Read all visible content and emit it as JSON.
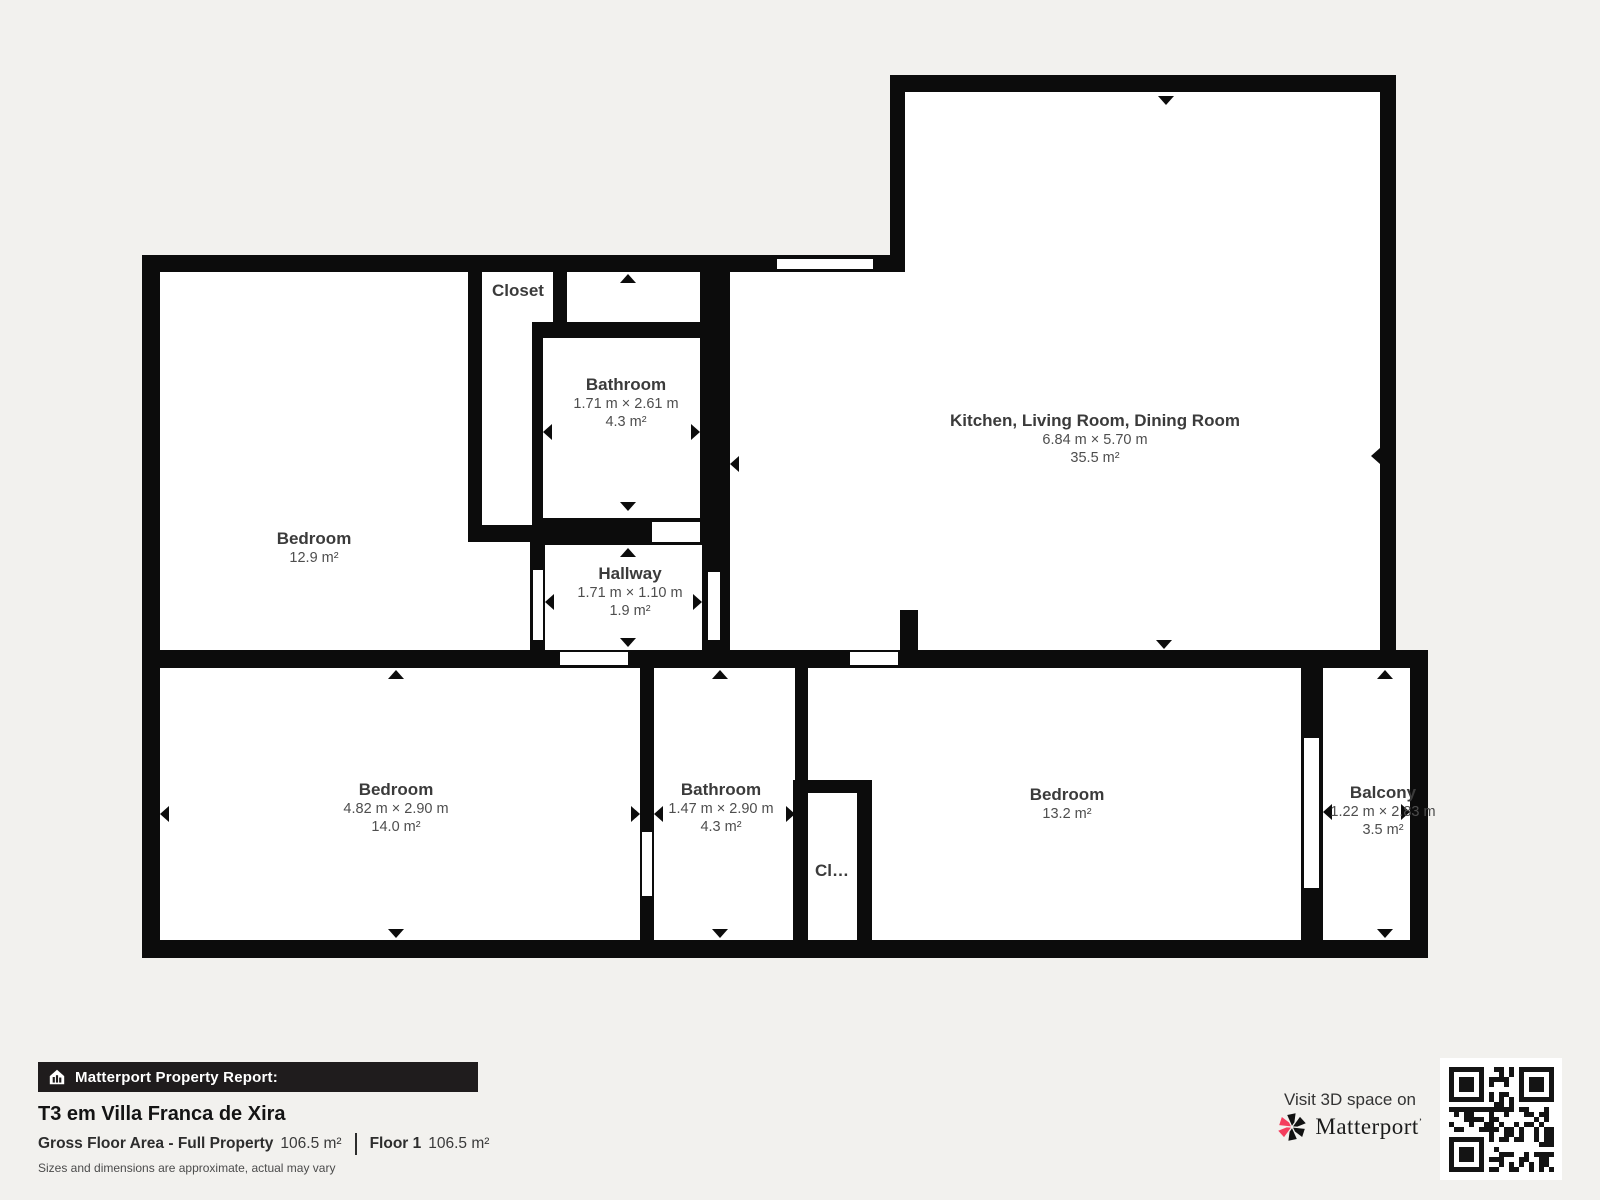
{
  "rooms": {
    "bedroom_tl": {
      "name": "Bedroom",
      "area": "12.9 m²"
    },
    "closet": {
      "name": "Closet"
    },
    "bathroom_tl": {
      "name": "Bathroom",
      "dims": "1.71 m × 2.61 m",
      "area": "4.3 m²"
    },
    "hallway": {
      "name": "Hallway",
      "dims": "1.71 m × 1.10 m",
      "area": "1.9 m²"
    },
    "kitchen": {
      "name": "Kitchen, Living Room, Dining Room",
      "dims": "6.84 m × 5.70 m",
      "area": "35.5 m²"
    },
    "bedroom_bl": {
      "name": "Bedroom",
      "dims": "4.82 m × 2.90 m",
      "area": "14.0 m²"
    },
    "bathroom_bl": {
      "name": "Bathroom",
      "dims": "1.47 m × 2.90 m",
      "area": "4.3 m²"
    },
    "closet_small": {
      "name": "Cl…"
    },
    "bedroom_br": {
      "name": "Bedroom",
      "area": "13.2 m²"
    },
    "balcony": {
      "name": "Balcony",
      "dims": "1.22 m × 2.83 m",
      "area": "3.5 m²"
    }
  },
  "footer": {
    "report_label": "Matterport Property Report:",
    "property_title": "T3 em Villa Franca de Xira",
    "gross_label": "Gross Floor Area - Full Property",
    "gross_value": "106.5 m²",
    "floor_label": "Floor 1",
    "floor_value": "106.5 m²",
    "disclaimer": "Sizes and dimensions are approximate, actual may vary",
    "visit_text": "Visit 3D space on",
    "brand": "Matterport"
  },
  "colors": {
    "wall": "#0c0c0c",
    "background": "#f2f1ee",
    "accent_pink": "#f43e5e"
  }
}
